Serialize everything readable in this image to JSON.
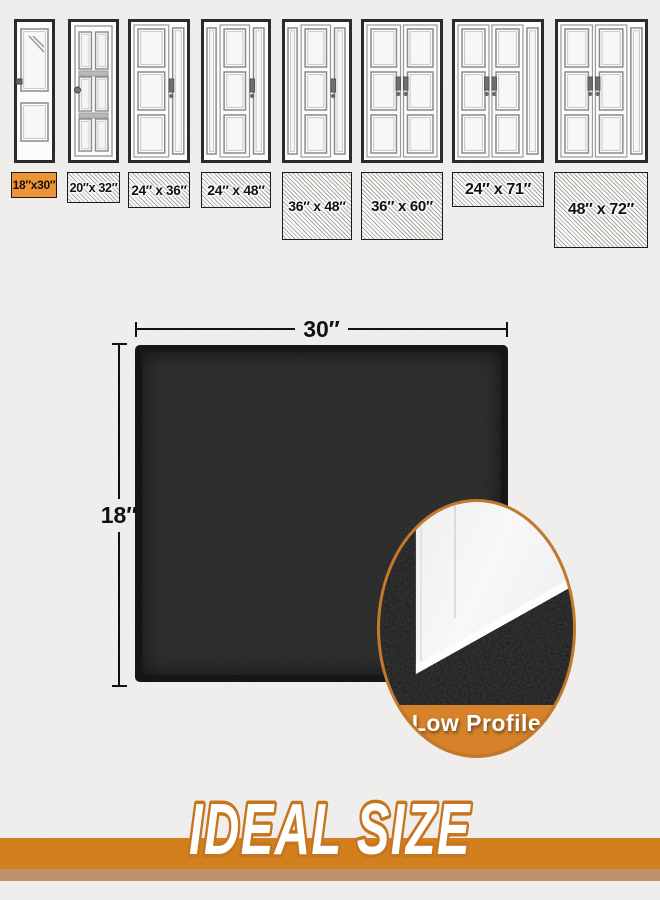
{
  "doors": [
    {
      "icon": "single-pane-door-icon",
      "label": "18″x30″",
      "selected": true
    },
    {
      "icon": "six-pane-door-icon",
      "label": "20″x 32″",
      "selected": false
    },
    {
      "icon": "panel-door-right-sidelight-icon",
      "label": "24″ x 36″",
      "selected": false
    },
    {
      "icon": "panel-door-two-sidelights-icon",
      "label": "24″ x 48″",
      "selected": false
    },
    {
      "icon": "panel-door-two-sidelights-icon",
      "label": "36″ x 48″",
      "selected": false
    },
    {
      "icon": "double-panel-door-icon",
      "label": "36″ x 60″",
      "selected": false
    },
    {
      "icon": "double-door-right-sidelight-icon",
      "label": "24″ x 71″",
      "selected": false
    },
    {
      "icon": "double-door-right-sidelight-icon",
      "label": "48″ x 72″",
      "selected": false
    }
  ],
  "mat": {
    "width_label": "30″",
    "height_label": "18″"
  },
  "inset": {
    "caption": "Low Profile"
  },
  "banner": {
    "title": "IDEAL SIZE"
  },
  "colors": {
    "selected_label_orange": "#ED9435",
    "banner_orange": "#D2801F",
    "banner_tan_strip": "#BE9168",
    "inset_ring_orange": "#C4782A",
    "inset_band_orange": "#D5822B",
    "mat_black": "#232323",
    "background": "#F1F0EE"
  }
}
